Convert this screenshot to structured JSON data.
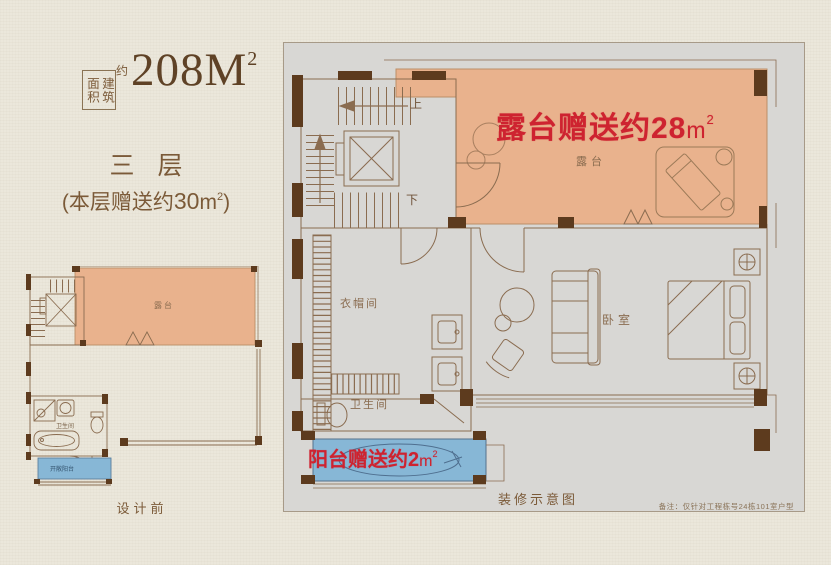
{
  "colors": {
    "page_bg": "#ebe7db",
    "panel_bg": "#d8d7d4",
    "accent_red": "#ce2330",
    "terrace_fill": "#e9b28d",
    "balcony_fill": "#87b7d6",
    "wall_brown": "#5d3b1e",
    "line_brown": "#8a6c50",
    "text_brown": "#7b5a38",
    "note_brown": "#8a7358"
  },
  "header": {
    "area_label_boxed": "建筑面积",
    "area_approx": "约",
    "area_value": "208",
    "area_unit": "M",
    "area_sup": "2",
    "floor_title": "三 层",
    "bonus_open": "(",
    "bonus_text": "本层赠送约",
    "bonus_value": "30",
    "bonus_unit": "m",
    "bonus_sup": "2",
    "bonus_close": ")"
  },
  "small_plan": {
    "terrace_label": "露台",
    "bathroom_label": "卫生间",
    "balcony_label": "开敞阳台",
    "caption": "设计前"
  },
  "main_plan": {
    "terrace_banner_text": "露台赠送约",
    "terrace_banner_value": "28",
    "terrace_banner_unit": "m",
    "terrace_banner_sup": "2",
    "balcony_banner_text": "阳台赠送约",
    "balcony_banner_value": "2",
    "balcony_banner_unit": "m",
    "balcony_banner_sup": "2",
    "up_label": "上",
    "down_label": "下",
    "terrace_label": "露台",
    "cloakroom_label": "衣帽间",
    "bathroom_label": "卫生间",
    "bedroom_label": "卧室",
    "caption": "装修示意图",
    "note": "备注：仅针对工程栋号24栋101室户型"
  }
}
